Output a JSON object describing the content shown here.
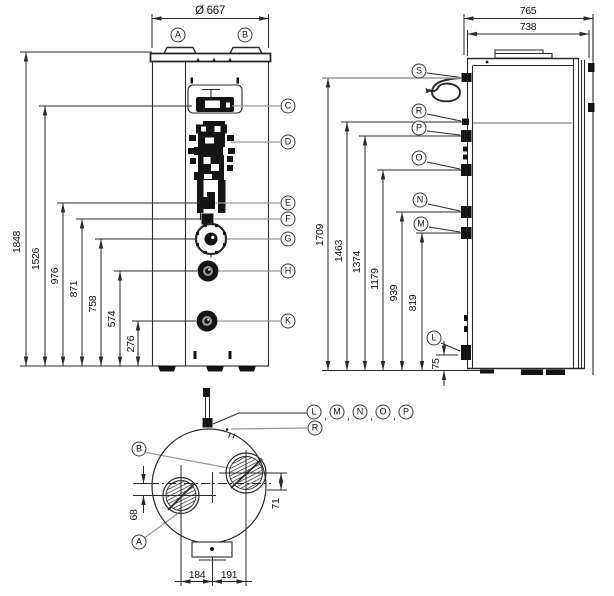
{
  "front_view": {
    "diameter_dim": "Ø 667",
    "height_dims": [
      "1848",
      "1526",
      "976",
      "871",
      "758",
      "574",
      "276"
    ],
    "top_callouts": [
      "A",
      "B"
    ],
    "right_callouts": [
      "C",
      "D",
      "E",
      "F",
      "G",
      "H",
      "K"
    ]
  },
  "side_view": {
    "depth_dims": [
      "765",
      "738"
    ],
    "height_dims": [
      "1709",
      "1463",
      "1374",
      "1179",
      "939",
      "819"
    ],
    "base_dim": "75",
    "left_callouts": [
      "S",
      "R",
      "P",
      "O",
      "N",
      "M",
      "L"
    ]
  },
  "top_view": {
    "group_callouts": [
      "L",
      "M",
      "N",
      "O",
      "P"
    ],
    "group_separator": ",",
    "rear_callout": "R",
    "port_callouts": [
      "B",
      "A"
    ],
    "offset_dims": [
      "68",
      "71"
    ],
    "spacing_dims": [
      "184",
      "191"
    ]
  },
  "colors": {
    "line": "#2a2a2a",
    "leader": "#9a9a9a",
    "fill_dark": "#141414",
    "background": "#ffffff"
  }
}
